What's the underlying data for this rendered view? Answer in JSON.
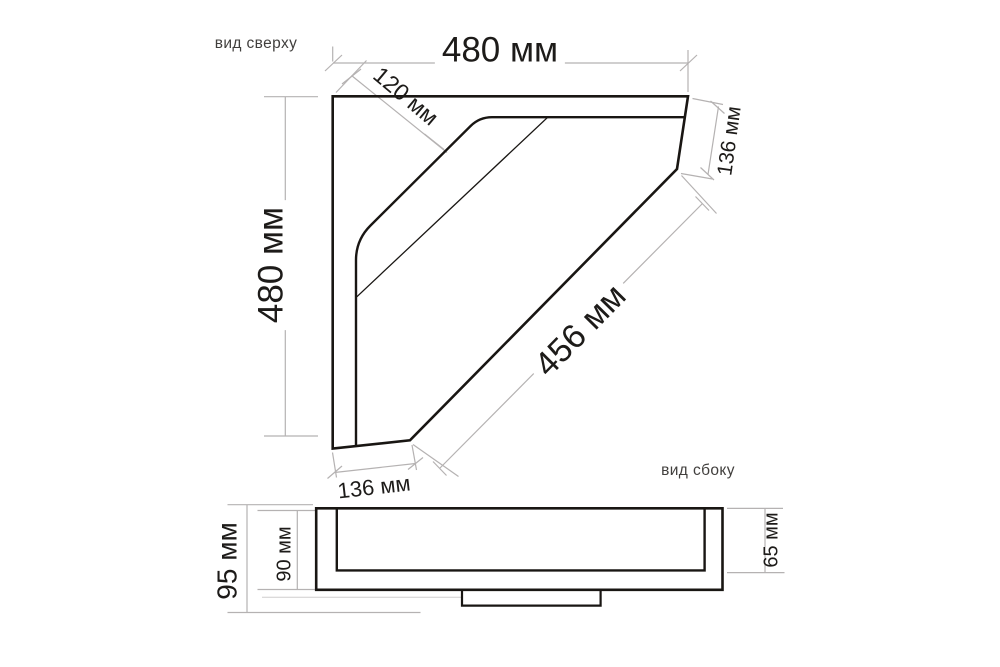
{
  "colors": {
    "background": "#ffffff",
    "outline": "#191613",
    "dimension_line": "#b5b2b2",
    "dimension_text": "#1d1b19",
    "label_text": "#413f3d"
  },
  "top_view": {
    "label": "вид сверху",
    "dims": {
      "width_top": "480 мм",
      "corner_rim": "120 мм",
      "right_edge": "136 мм",
      "depth_left": "480 мм",
      "front_diagonal": "456 мм",
      "bottom_edge": "136 мм"
    }
  },
  "side_view": {
    "label": "вид сбоку",
    "dims": {
      "total_height": "95 мм",
      "body_height": "90 мм",
      "front_height": "65 мм"
    }
  }
}
